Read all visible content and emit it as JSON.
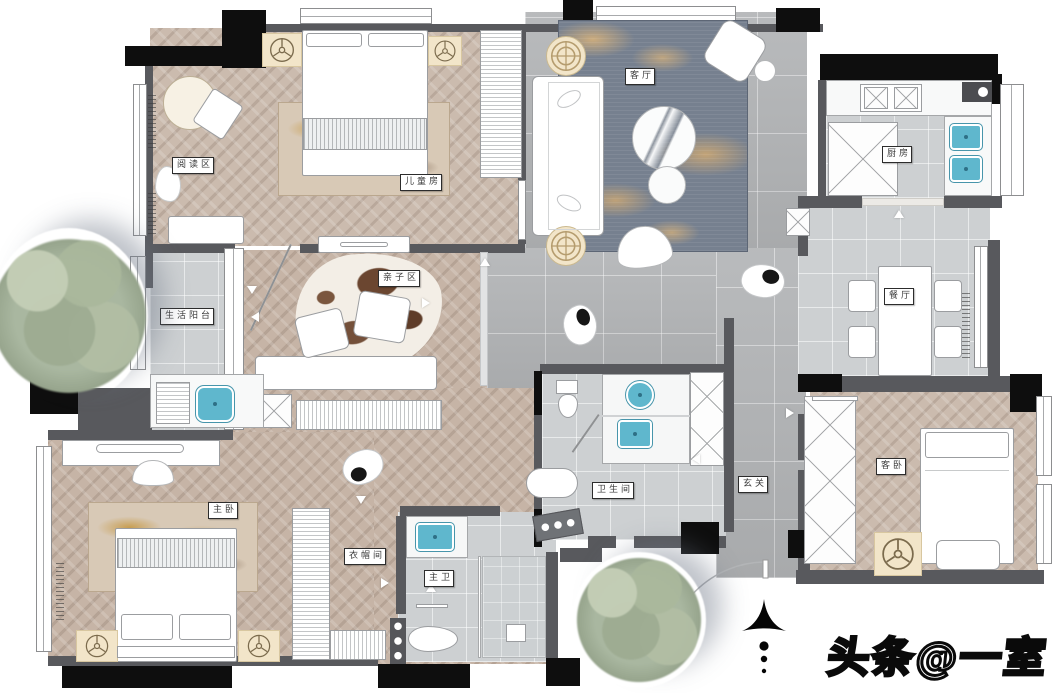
{
  "watermark": "头条@一室",
  "rooms": {
    "reading_area": {
      "label": "阅读区"
    },
    "kids_room": {
      "label": "儿童房"
    },
    "living_room": {
      "label": "客厅"
    },
    "kitchen": {
      "label": "厨房"
    },
    "dining_room": {
      "label": "餐厅"
    },
    "guest_bedroom": {
      "label": "客卧"
    },
    "bathroom": {
      "label": "卫生间"
    },
    "entry": {
      "label": "玄关"
    },
    "service_balcony": {
      "label": "生活阳台"
    },
    "family_area": {
      "label": "亲子区"
    },
    "master_bedroom": {
      "label": "主卧"
    },
    "cloakroom": {
      "label": "衣帽间"
    },
    "master_bath": {
      "label": "主卫"
    }
  },
  "colors": {
    "wood_floor": "#c6b4a6",
    "tile_gray": "#b5b7b9",
    "tile_light": "#cdd0d2",
    "wall_dark": "#58595d",
    "wall_black": "#0e0e0e",
    "sink_blue": "#5fb7cd",
    "rug_blue": "#76808f",
    "rug_gold": "#c8a878",
    "mat_beige": "#f2e5c9",
    "tree_green": "#a9b7a0"
  },
  "icons": {
    "north_arrow": "north-arrow-icon",
    "ceiling_fan": "fan-symbol-icon",
    "plant_table": "round-plant-table-icon"
  }
}
